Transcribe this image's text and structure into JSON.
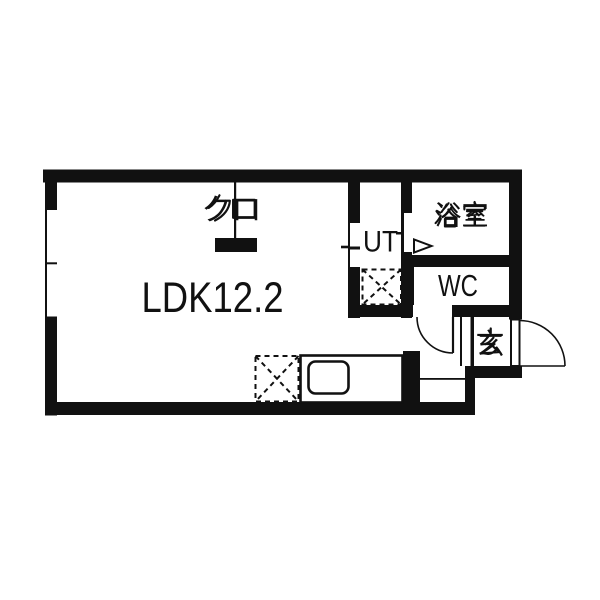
{
  "page": {
    "background": "#ffffff"
  },
  "floorplan": {
    "colors": {
      "wall": "#111111",
      "floor": "#ffffff",
      "line": "#111111"
    },
    "rooms": [
      {
        "id": "ldk",
        "label": "LDK12.2"
      },
      {
        "id": "closet",
        "label": "クロ"
      },
      {
        "id": "utility",
        "label": "UT"
      },
      {
        "id": "bathroom",
        "label": "浴室"
      },
      {
        "id": "toilet",
        "label": "WC"
      },
      {
        "id": "entrance",
        "label": "玄"
      }
    ]
  }
}
